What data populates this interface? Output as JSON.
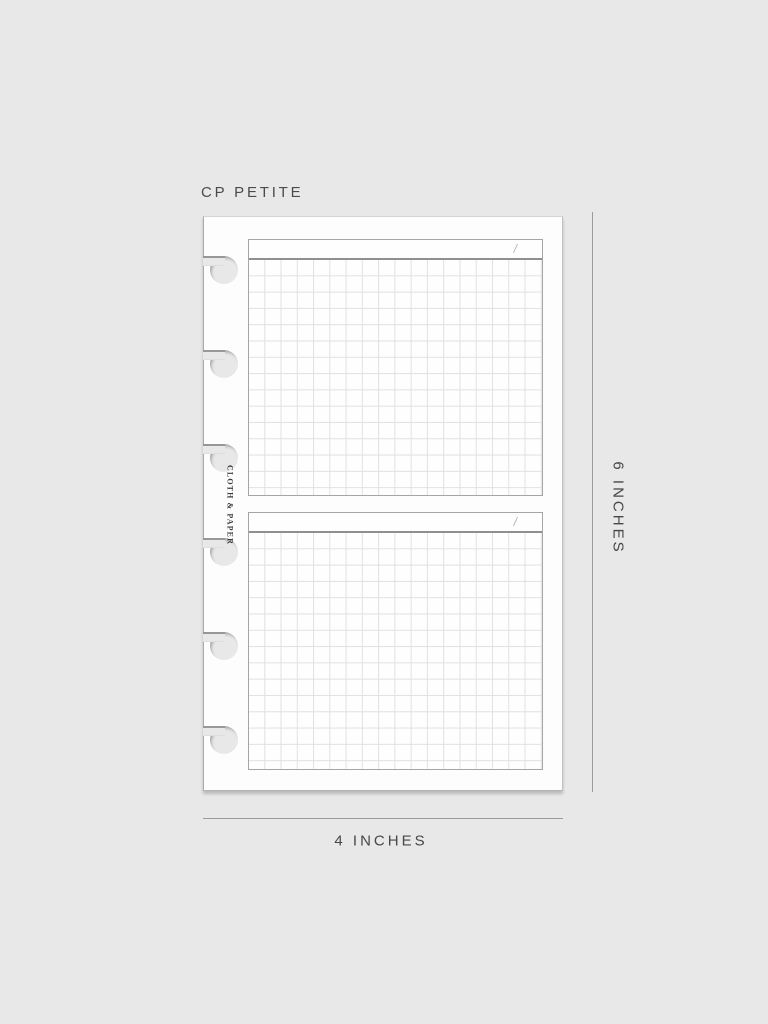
{
  "labels": {
    "variant": "CP PETITE",
    "brand": "CLOTH & PAPER",
    "height_dimension": "6 INCHES",
    "width_dimension": "4 INCHES"
  },
  "sections": [
    {
      "name": "top-grid-section",
      "header_slash": "/"
    },
    {
      "name": "bottom-grid-section",
      "header_slash": "/"
    }
  ],
  "binding": {
    "type": "disc-punch",
    "hole_count": 6
  },
  "colors": {
    "background": "#e8e8e8",
    "paper": "#fdfdfd",
    "section_border": "#a5a5a5",
    "header_separator": "#8f8f8f",
    "grid_line": "#e1e1e1",
    "dimension_line": "#9c9c9c",
    "label_text": "#474747",
    "slash_mark": "#b3b3b3"
  }
}
